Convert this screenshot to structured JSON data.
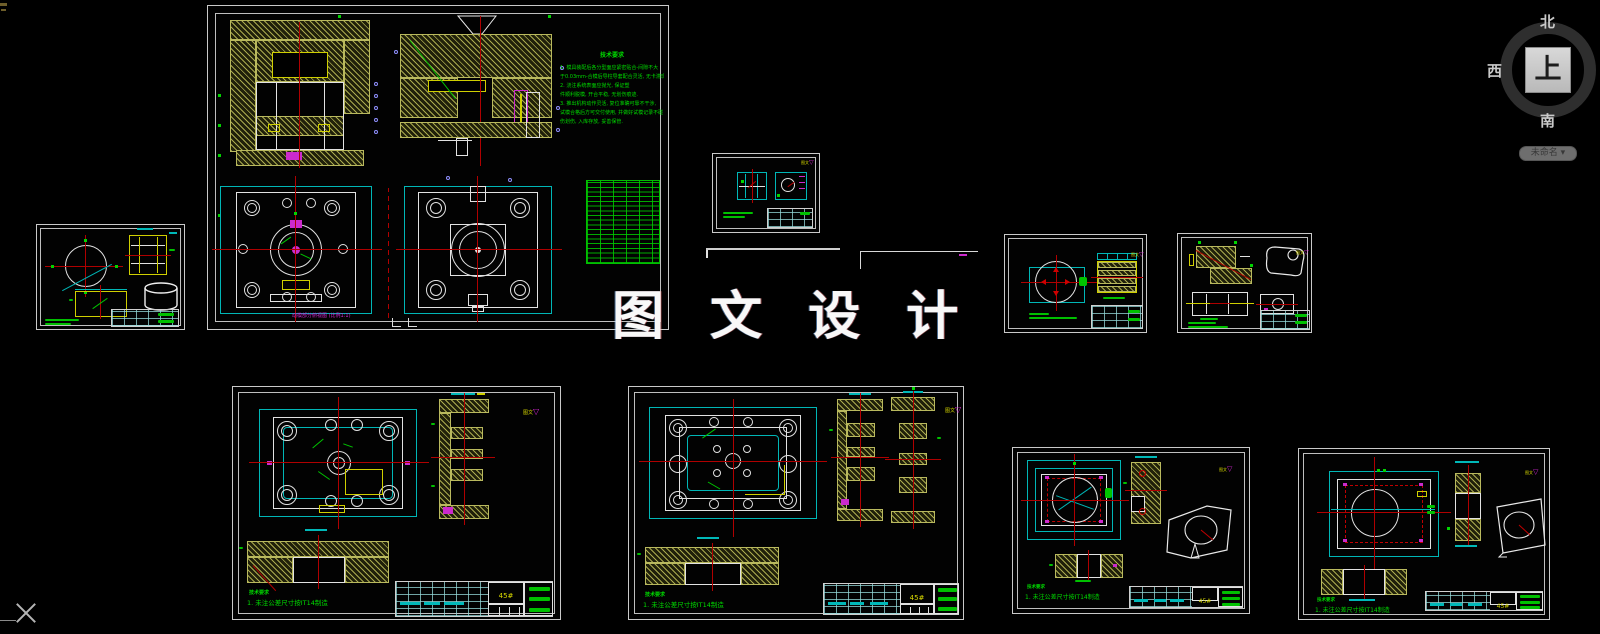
{
  "watermark": {
    "text": "图 文 设 计"
  },
  "viewcube": {
    "north": "北",
    "west": "西",
    "south": "南",
    "up": "上",
    "ucs_label": "未命名",
    "caret": "▾"
  },
  "brand": {
    "logo_text": "图文",
    "logo_mark": "▽"
  },
  "main": {
    "tech_title": "技术要求",
    "tech_lines": [
      "1. 模具装配后各分型面应紧密贴合-间隙不大",
      "于0.03mm-合模后导柱导套配合灵活, 无卡滞现象.",
      "2. 浇注系统表面应抛光, 保证塑",
      "件顺利脱模, 开合平稳, 无划伤痕迹.",
      "3. 推出机构动作灵活, 复位准确可靠不干涉,",
      "试模合格后方可交付使用, 并做好试模记录不碰",
      "伤划伤, 入库存放, 妥善保管."
    ],
    "caption": "动模部分俯视图 (比例1:1)",
    "bom_rows": 18
  },
  "notes": {
    "title": "技术要求",
    "line1": "1. 未注公差尺寸按IT14制造"
  },
  "titleblock": {
    "material": "45#"
  }
}
